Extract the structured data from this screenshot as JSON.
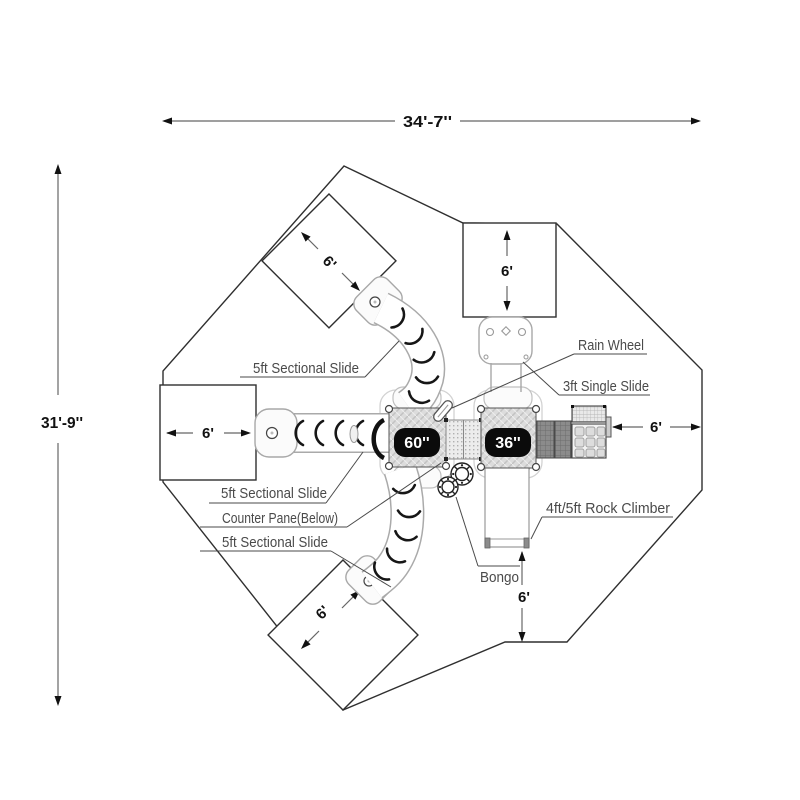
{
  "dimensions": {
    "overall_width": "34'-7''",
    "overall_height": "31'-9''",
    "top_square": "6'",
    "left_square": "6'",
    "upper_diamond": "6'",
    "lower_diamond": "6'",
    "right_clearance": "6'",
    "bottom_clearance": "6'"
  },
  "decks": {
    "left_badge": "60''",
    "right_badge": "36''"
  },
  "labels": {
    "slide_ne": "5ft Sectional Slide",
    "slide_w": "5ft Sectional Slide",
    "counter_pane": "Counter Pane(Below)",
    "slide_sw": "5ft Sectional Slide",
    "rain_wheel": "Rain Wheel",
    "single_slide": "3ft Single Slide",
    "rock_climber": "4ft/5ft Rock Climber",
    "bongo": "Bongo"
  }
}
